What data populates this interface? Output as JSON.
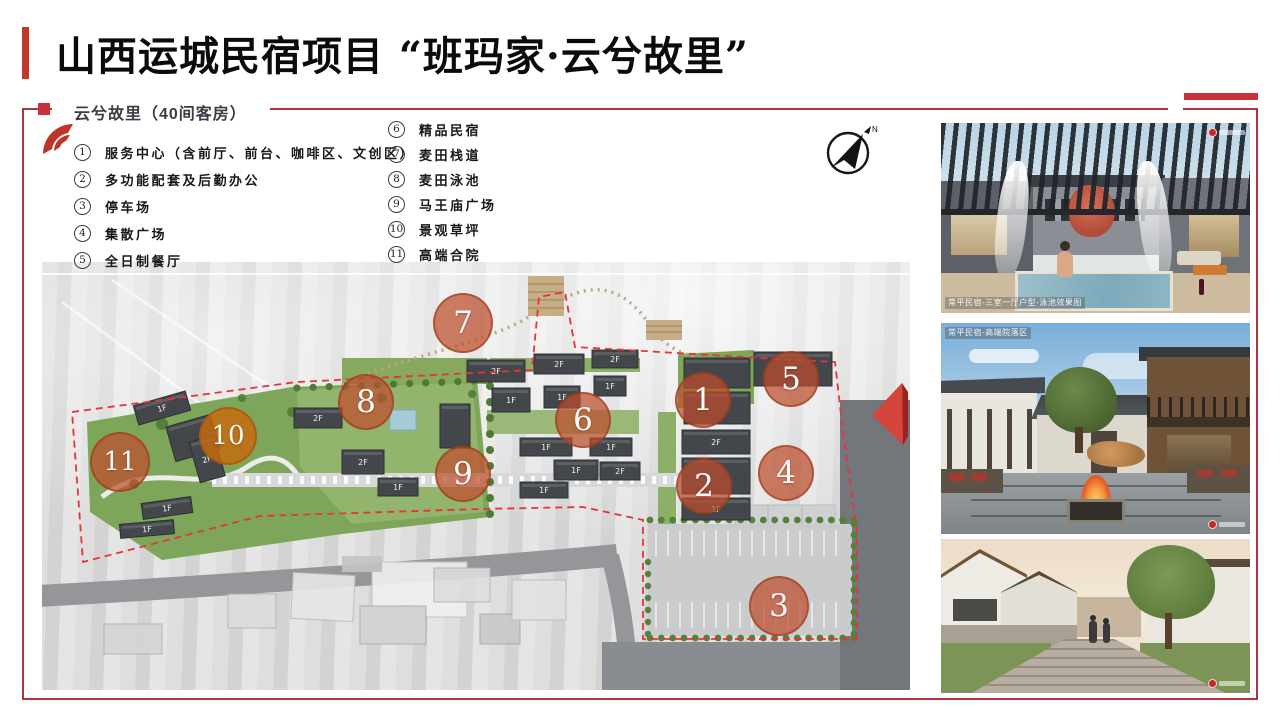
{
  "slide": {
    "title": "山西运城民宿项目 “班玛家·云兮故里”",
    "subtitle": "云兮故里（40间客房）"
  },
  "legend": {
    "items_left": [
      {
        "no": "1",
        "label": "服务中心（含前厅、前台、咖啡区、文创区）"
      },
      {
        "no": "2",
        "label": "多功能配套及后勤办公"
      },
      {
        "no": "3",
        "label": "停车场"
      },
      {
        "no": "4",
        "label": "集散广场"
      },
      {
        "no": "5",
        "label": "全日制餐厅"
      }
    ],
    "items_right": [
      {
        "no": "6",
        "label": "精品民宿"
      },
      {
        "no": "7",
        "label": "麦田栈道"
      },
      {
        "no": "8",
        "label": "麦田泳池"
      },
      {
        "no": "9",
        "label": "马王庙广场"
      },
      {
        "no": "10",
        "label": "景观草坪"
      },
      {
        "no": "11",
        "label": "高端合院"
      }
    ]
  },
  "map": {
    "north_label": "N",
    "markers": [
      {
        "no": "1",
        "x": 661,
        "y": 138,
        "r": 28
      },
      {
        "no": "2",
        "x": 662,
        "y": 224,
        "r": 28
      },
      {
        "no": "3",
        "x": 737,
        "y": 344,
        "r": 30
      },
      {
        "no": "4",
        "x": 744,
        "y": 211,
        "r": 28
      },
      {
        "no": "5",
        "x": 749,
        "y": 117,
        "r": 28
      },
      {
        "no": "6",
        "x": 541,
        "y": 158,
        "r": 28
      },
      {
        "no": "7",
        "x": 421,
        "y": 61,
        "r": 30
      },
      {
        "no": "8",
        "x": 324,
        "y": 140,
        "r": 28
      },
      {
        "no": "9",
        "x": 421,
        "y": 212,
        "r": 28
      },
      {
        "no": "10",
        "x": 186,
        "y": 174,
        "r": 29,
        "alt": true
      },
      {
        "no": "11",
        "x": 78,
        "y": 200,
        "r": 30
      }
    ],
    "buildings": [
      {
        "x": 93,
        "y": 136,
        "w": 54,
        "h": 20,
        "rot": -16,
        "label": "1F"
      },
      {
        "x": 128,
        "y": 158,
        "w": 46,
        "h": 36,
        "rot": -16,
        "label": ""
      },
      {
        "x": 152,
        "y": 176,
        "w": 26,
        "h": 42,
        "rot": -16,
        "label": "2F"
      },
      {
        "x": 100,
        "y": 238,
        "w": 50,
        "h": 16,
        "rot": -8,
        "label": "1F"
      },
      {
        "x": 78,
        "y": 260,
        "w": 54,
        "h": 14,
        "rot": -5,
        "label": "1F"
      },
      {
        "x": 252,
        "y": 146,
        "w": 48,
        "h": 20,
        "rot": 0,
        "label": "2F"
      },
      {
        "x": 300,
        "y": 188,
        "w": 42,
        "h": 24,
        "rot": 0,
        "label": "2F"
      },
      {
        "x": 336,
        "y": 216,
        "w": 40,
        "h": 18,
        "rot": 0,
        "label": "1F"
      },
      {
        "x": 398,
        "y": 142,
        "w": 30,
        "h": 44,
        "rot": 0,
        "label": ""
      },
      {
        "x": 425,
        "y": 98,
        "w": 58,
        "h": 22,
        "rot": 0,
        "label": "2F"
      },
      {
        "x": 492,
        "y": 92,
        "w": 50,
        "h": 20,
        "rot": 0,
        "label": "2F"
      },
      {
        "x": 550,
        "y": 88,
        "w": 46,
        "h": 18,
        "rot": 0,
        "label": "2F"
      },
      {
        "x": 450,
        "y": 126,
        "w": 38,
        "h": 24,
        "rot": 0,
        "label": "1F"
      },
      {
        "x": 502,
        "y": 124,
        "w": 36,
        "h": 22,
        "rot": 0,
        "label": "1F"
      },
      {
        "x": 552,
        "y": 114,
        "w": 32,
        "h": 20,
        "rot": 0,
        "label": "1F"
      },
      {
        "x": 478,
        "y": 176,
        "w": 52,
        "h": 18,
        "rot": 0,
        "label": "1F"
      },
      {
        "x": 548,
        "y": 176,
        "w": 42,
        "h": 18,
        "rot": 0,
        "label": "1F"
      },
      {
        "x": 512,
        "y": 198,
        "w": 44,
        "h": 20,
        "rot": 0,
        "label": "1F"
      },
      {
        "x": 558,
        "y": 200,
        "w": 40,
        "h": 18,
        "rot": 0,
        "label": "2F"
      },
      {
        "x": 478,
        "y": 220,
        "w": 48,
        "h": 16,
        "rot": 0,
        "label": "1F"
      },
      {
        "x": 642,
        "y": 96,
        "w": 66,
        "h": 30,
        "rot": 0,
        "label": ""
      },
      {
        "x": 642,
        "y": 130,
        "w": 66,
        "h": 32,
        "rot": 0,
        "label": ""
      },
      {
        "x": 712,
        "y": 90,
        "w": 78,
        "h": 34,
        "rot": 0,
        "label": ""
      },
      {
        "x": 640,
        "y": 168,
        "w": 68,
        "h": 24,
        "rot": 0,
        "label": "2F"
      },
      {
        "x": 640,
        "y": 196,
        "w": 68,
        "h": 36,
        "rot": 0,
        "label": ""
      },
      {
        "x": 640,
        "y": 236,
        "w": 68,
        "h": 22,
        "rot": 0,
        "label": "1F"
      }
    ]
  },
  "photos": [
    {
      "caption": "常平民宿-三室一厅户型-泳池效果图"
    },
    {
      "caption": "常平民宿-高端院落区"
    },
    {
      "caption": ""
    }
  ],
  "colors": {
    "accent": "#c9303c",
    "marker": "#be4e2d",
    "boundary": "#e8323c"
  }
}
